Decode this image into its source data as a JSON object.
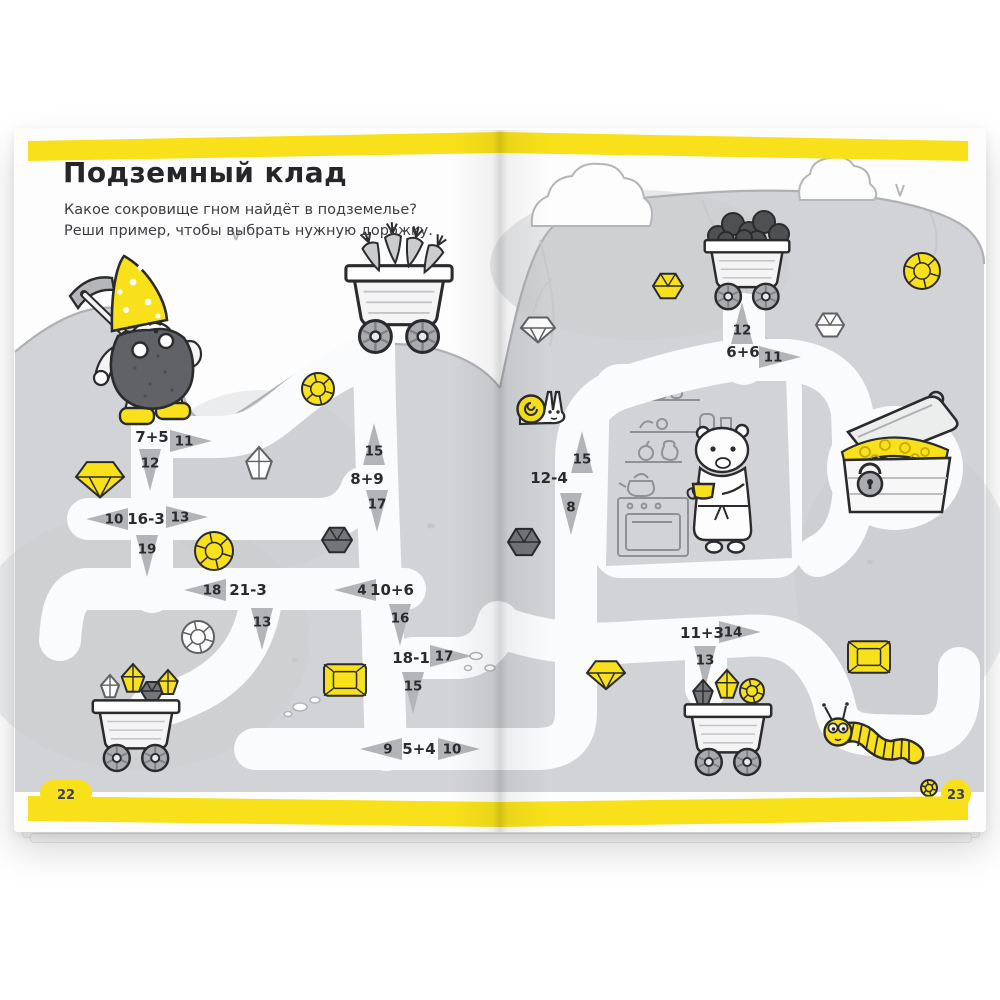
{
  "page": {
    "title": "Подземный клад",
    "subtitle_line1": "Какое сокровище гном найдёт в подземелье?",
    "subtitle_line2": "Реши пример, чтобы выбрать нужную дорожку.",
    "page_number_left": "22",
    "page_number_right": "23"
  },
  "colors": {
    "accent_yellow": "#f8e11a",
    "ground_gray": "#d2d3d6",
    "path_white": "#fafbfc",
    "arrow_gray": "#b2b4b8",
    "ink": "#2b2b2e"
  },
  "maze": {
    "junctions": [
      {
        "expr": "7+5",
        "x": 152,
        "y": 437,
        "arrows": [
          {
            "label": "11",
            "x": 184,
            "y": 441,
            "dir": "right"
          },
          {
            "label": "12",
            "x": 150,
            "y": 463,
            "dir": "down"
          }
        ]
      },
      {
        "expr": "16-3",
        "x": 146,
        "y": 519,
        "arrows": [
          {
            "label": "10",
            "x": 114,
            "y": 519,
            "dir": "left"
          },
          {
            "label": "13",
            "x": 180,
            "y": 517,
            "dir": "right"
          },
          {
            "label": "19",
            "x": 147,
            "y": 549,
            "dir": "down"
          }
        ]
      },
      {
        "expr": "21-3",
        "x": 248,
        "y": 590,
        "arrows": [
          {
            "label": "18",
            "x": 212,
            "y": 590,
            "dir": "left"
          },
          {
            "label": "13",
            "x": 262,
            "y": 622,
            "dir": "down"
          }
        ]
      },
      {
        "expr": "8+9",
        "x": 367,
        "y": 479,
        "arrows": [
          {
            "label": "15",
            "x": 374,
            "y": 451,
            "dir": "up"
          },
          {
            "label": "17",
            "x": 377,
            "y": 504,
            "dir": "down"
          }
        ]
      },
      {
        "expr": "10+6",
        "x": 392,
        "y": 590,
        "arrows": [
          {
            "label": "4",
            "x": 362,
            "y": 590,
            "dir": "left"
          },
          {
            "label": "16",
            "x": 400,
            "y": 618,
            "dir": "down"
          }
        ]
      },
      {
        "expr": "18-1",
        "x": 411,
        "y": 658,
        "arrows": [
          {
            "label": "17",
            "x": 444,
            "y": 656,
            "dir": "right"
          },
          {
            "label": "15",
            "x": 413,
            "y": 686,
            "dir": "down"
          }
        ]
      },
      {
        "expr": "5+4",
        "x": 419,
        "y": 749,
        "arrows": [
          {
            "label": "9",
            "x": 388,
            "y": 749,
            "dir": "left"
          },
          {
            "label": "10",
            "x": 452,
            "y": 749,
            "dir": "right"
          }
        ]
      },
      {
        "expr": "12-4",
        "x": 549,
        "y": 478,
        "arrows": [
          {
            "label": "15",
            "x": 582,
            "y": 459,
            "dir": "up"
          },
          {
            "label": "8",
            "x": 571,
            "y": 507,
            "dir": "down"
          }
        ]
      },
      {
        "expr": "6+6",
        "x": 743,
        "y": 352,
        "arrows": [
          {
            "label": "12",
            "x": 742,
            "y": 330,
            "dir": "up"
          },
          {
            "label": "11",
            "x": 773,
            "y": 357,
            "dir": "right"
          }
        ]
      },
      {
        "expr": "11+3",
        "x": 702,
        "y": 633,
        "arrows": [
          {
            "label": "14",
            "x": 733,
            "y": 632,
            "dir": "right"
          },
          {
            "label": "13",
            "x": 705,
            "y": 660,
            "dir": "down"
          }
        ]
      }
    ],
    "gems": [
      {
        "t": "diamond",
        "c": "yellow",
        "x": 100,
        "y": 477,
        "s": 24
      },
      {
        "t": "crystal",
        "c": "white",
        "x": 259,
        "y": 464,
        "s": 17
      },
      {
        "t": "round",
        "c": "yellow",
        "x": 214,
        "y": 551,
        "s": 19
      },
      {
        "t": "round",
        "c": "yellow",
        "x": 318,
        "y": 389,
        "s": 16
      },
      {
        "t": "hex",
        "c": "dark",
        "x": 337,
        "y": 540,
        "s": 15
      },
      {
        "t": "diamond",
        "c": "white",
        "x": 538,
        "y": 328,
        "s": 17
      },
      {
        "t": "round",
        "c": "white",
        "x": 198,
        "y": 637,
        "s": 16
      },
      {
        "t": "emerald",
        "c": "yellow",
        "x": 345,
        "y": 680,
        "s": 21
      },
      {
        "t": "hex",
        "c": "dark",
        "x": 524,
        "y": 542,
        "s": 16
      },
      {
        "t": "diamond",
        "c": "yellow",
        "x": 606,
        "y": 673,
        "s": 19
      },
      {
        "t": "hex",
        "c": "yellow",
        "x": 668,
        "y": 286,
        "s": 15
      },
      {
        "t": "round",
        "c": "yellow",
        "x": 922,
        "y": 271,
        "s": 18
      },
      {
        "t": "hex",
        "c": "white",
        "x": 830,
        "y": 325,
        "s": 14
      },
      {
        "t": "emerald",
        "c": "yellow",
        "x": 869,
        "y": 657,
        "s": 21
      },
      {
        "t": "crystal",
        "c": "white",
        "x": 110,
        "y": 687,
        "s": 12
      },
      {
        "t": "crystal",
        "c": "yellow",
        "x": 133,
        "y": 679,
        "s": 15
      },
      {
        "t": "hex",
        "c": "dark",
        "x": 152,
        "y": 691,
        "s": 11
      },
      {
        "t": "crystal",
        "c": "yellow",
        "x": 168,
        "y": 683,
        "s": 13
      },
      {
        "t": "crystal",
        "c": "dark",
        "x": 703,
        "y": 693,
        "s": 13
      },
      {
        "t": "crystal",
        "c": "yellow",
        "x": 727,
        "y": 685,
        "s": 15
      },
      {
        "t": "round",
        "c": "yellow",
        "x": 752,
        "y": 691,
        "s": 12
      },
      {
        "t": "round",
        "c": "yellow",
        "x": 929,
        "y": 788,
        "s": 8
      }
    ],
    "illustrations": [
      "gnome-miner",
      "carrot-cart",
      "coal-cart",
      "gem-cart-left",
      "gem-cart-right",
      "treasure-chest",
      "hamster-room",
      "snail",
      "caterpillar"
    ]
  }
}
